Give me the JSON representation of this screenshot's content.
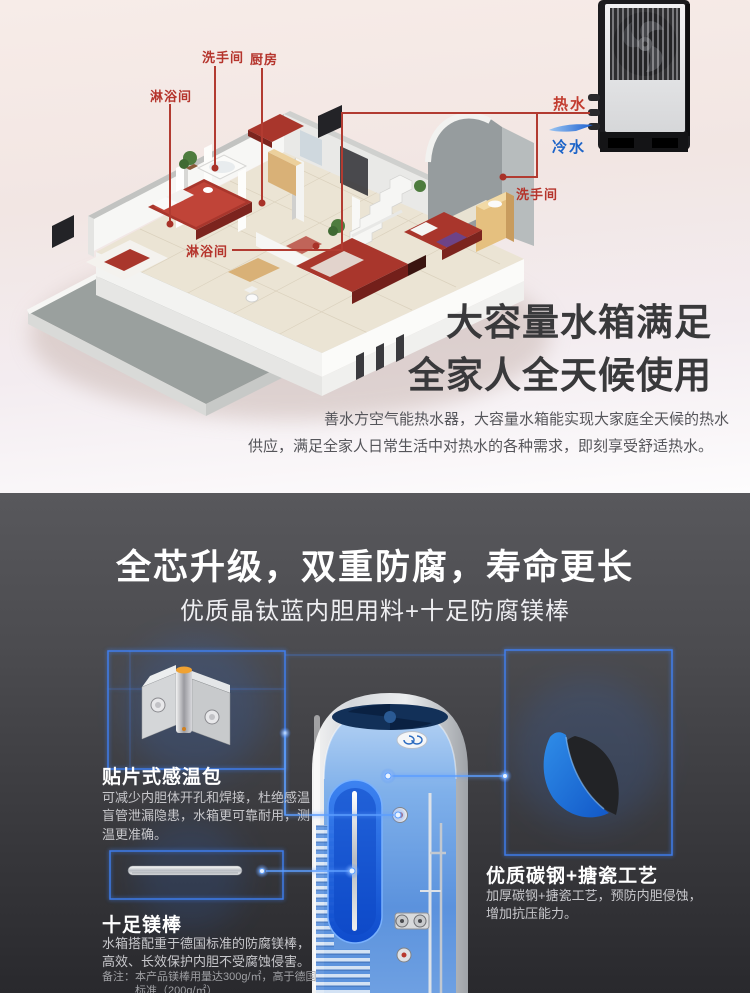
{
  "top_section": {
    "labels": {
      "shower_left": "淋浴间",
      "washroom_top": "洗手间",
      "kitchen": "厨房",
      "shower_bottom": "淋浴间",
      "washroom_right": "洗手间",
      "hot_water": "热水",
      "cold_water": "冷水"
    },
    "headline": {
      "line1": "大容量水箱满足",
      "line2": "全家人全天候使用"
    },
    "body": {
      "line1": "善水方空气能热水器，大容量水箱能实现大家庭全天候的热水",
      "line2": "供应，满足全家人日常生活中对热水的各种需求，即刻享受舒适热水。"
    }
  },
  "dark_section": {
    "title": "全芯升级，双重防腐，寿命更长",
    "subtitle": "优质晶钛蓝内胆用料+十足防腐镁棒",
    "features": {
      "sensor": {
        "title": "贴片式感温包",
        "desc": "可减少内胆体开孔和焊接，杜绝感温盲管泄漏隐患，水箱更可靠耐用，测温更准确。"
      },
      "rod": {
        "title": "十足镁棒",
        "desc": "水箱搭配重于德国标准的防腐镁棒，高效、长效保护内胆不受腐蚀侵害。",
        "note_line1": "备注：本产品镁棒用量达300g/㎡，高于德国",
        "note_line2": "标准（200g/㎡）"
      },
      "enamel": {
        "title": "优质碳钢+搪瓷工艺",
        "desc": "加厚碳钢+搪瓷工艺，预防内胆侵蚀，增加抗压能力。"
      }
    }
  },
  "colors": {
    "accent_red": "#b5342c",
    "accent_blue": "#1d64c8",
    "glow_blue": "#3f84ff",
    "headline_gray": "#39393b",
    "dark_bg_top": "#58585c",
    "dark_bg_bottom": "#29292d"
  }
}
